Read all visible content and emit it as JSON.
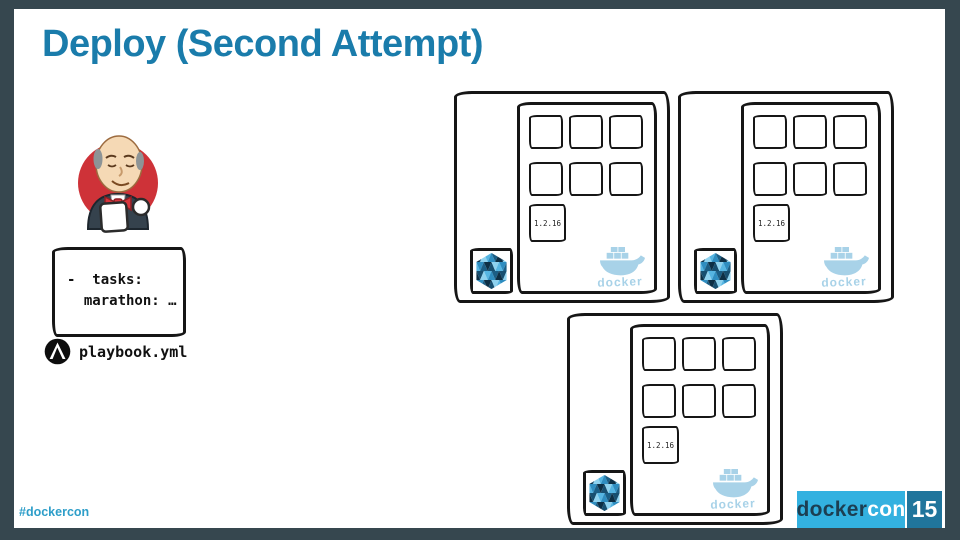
{
  "header": {
    "title": "Deploy (Second Attempt)"
  },
  "playbook_panel": {
    "code_line_1": "-  tasks:",
    "code_line_2": "  marathon: …",
    "filename": "playbook.yml"
  },
  "hosts": [
    {
      "version": "1.2.16",
      "docker_label": "docker",
      "container_slots": 6
    },
    {
      "version": "1.2.16",
      "docker_label": "docker",
      "container_slots": 6
    },
    {
      "version": "1.2.16",
      "docker_label": "docker",
      "container_slots": 6
    }
  ],
  "footer": {
    "hashtag": "#dockercon",
    "brand_docker": "docker",
    "brand_con": "con",
    "page_number": "15"
  },
  "colors": {
    "frame": "#36474f",
    "title_teal": "#1a7cab",
    "brand_blue": "#33b1e0",
    "page_box_teal": "#20759c",
    "watermark_blue": "#a8d2e8",
    "sketch_ink": "#161616",
    "jenkins_red": "#ce3238"
  }
}
